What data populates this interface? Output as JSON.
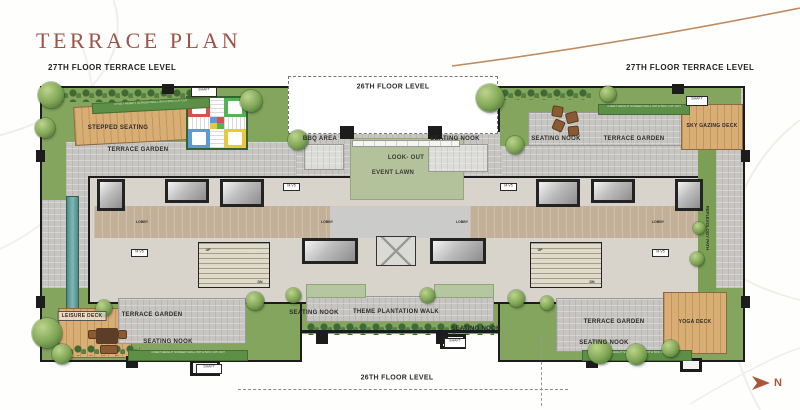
{
  "title": "TERRACE PLAN",
  "levels": {
    "terrace_left": "27TH FLOOR TERRACE LEVEL",
    "terrace_right": "27TH FLOOR TERRACE LEVEL",
    "floor_above_top": "26TH FLOOR LEVEL",
    "floor_above_bottom": "26TH FLOOR LEVEL"
  },
  "labels": {
    "stepped_seating": "STEPPED SEATING",
    "terrace_garden": "TERRACE GARDEN",
    "bbq_area": "BBQ AREA",
    "seating_nook": "SEATING NOOK",
    "look_out": "LOOK- OUT",
    "event_lawn": "EVENT LAWN",
    "sky_gazing_deck": "SKY GAZING DECK",
    "reflexology_path": "REFLEXOLOGY PATH",
    "leisure_deck": "LEISURE DECK",
    "theme_plantation_walk": "THEME PLANTATION WALK",
    "yoga_deck": "YOGA DECK"
  },
  "core": {
    "lobby": "LOBBY",
    "up": "UP",
    "dn": "DN",
    "shaft": "SHAFT",
    "vent_shaft": "M-V5"
  },
  "notes": {
    "screen_wall": "4 FEET HEIGHT SCREEN WALL WITH 50% CUT-OUT"
  },
  "compass": {
    "north": "N"
  },
  "colors": {
    "title": "#9c5348",
    "garden_green": "#83a55e",
    "lawn_green": "#b3c29a",
    "paving_gray": "#c6c5c2",
    "deck_wood": "#d9ae74",
    "wall_black": "#1c1c1c",
    "water_teal": "#5f9a97",
    "accent_brown": "#a8573b",
    "ludo_red": "#d94f4f",
    "ludo_green": "#57b157",
    "ludo_blue": "#5b9bd5",
    "ludo_yellow": "#e8c93e"
  }
}
